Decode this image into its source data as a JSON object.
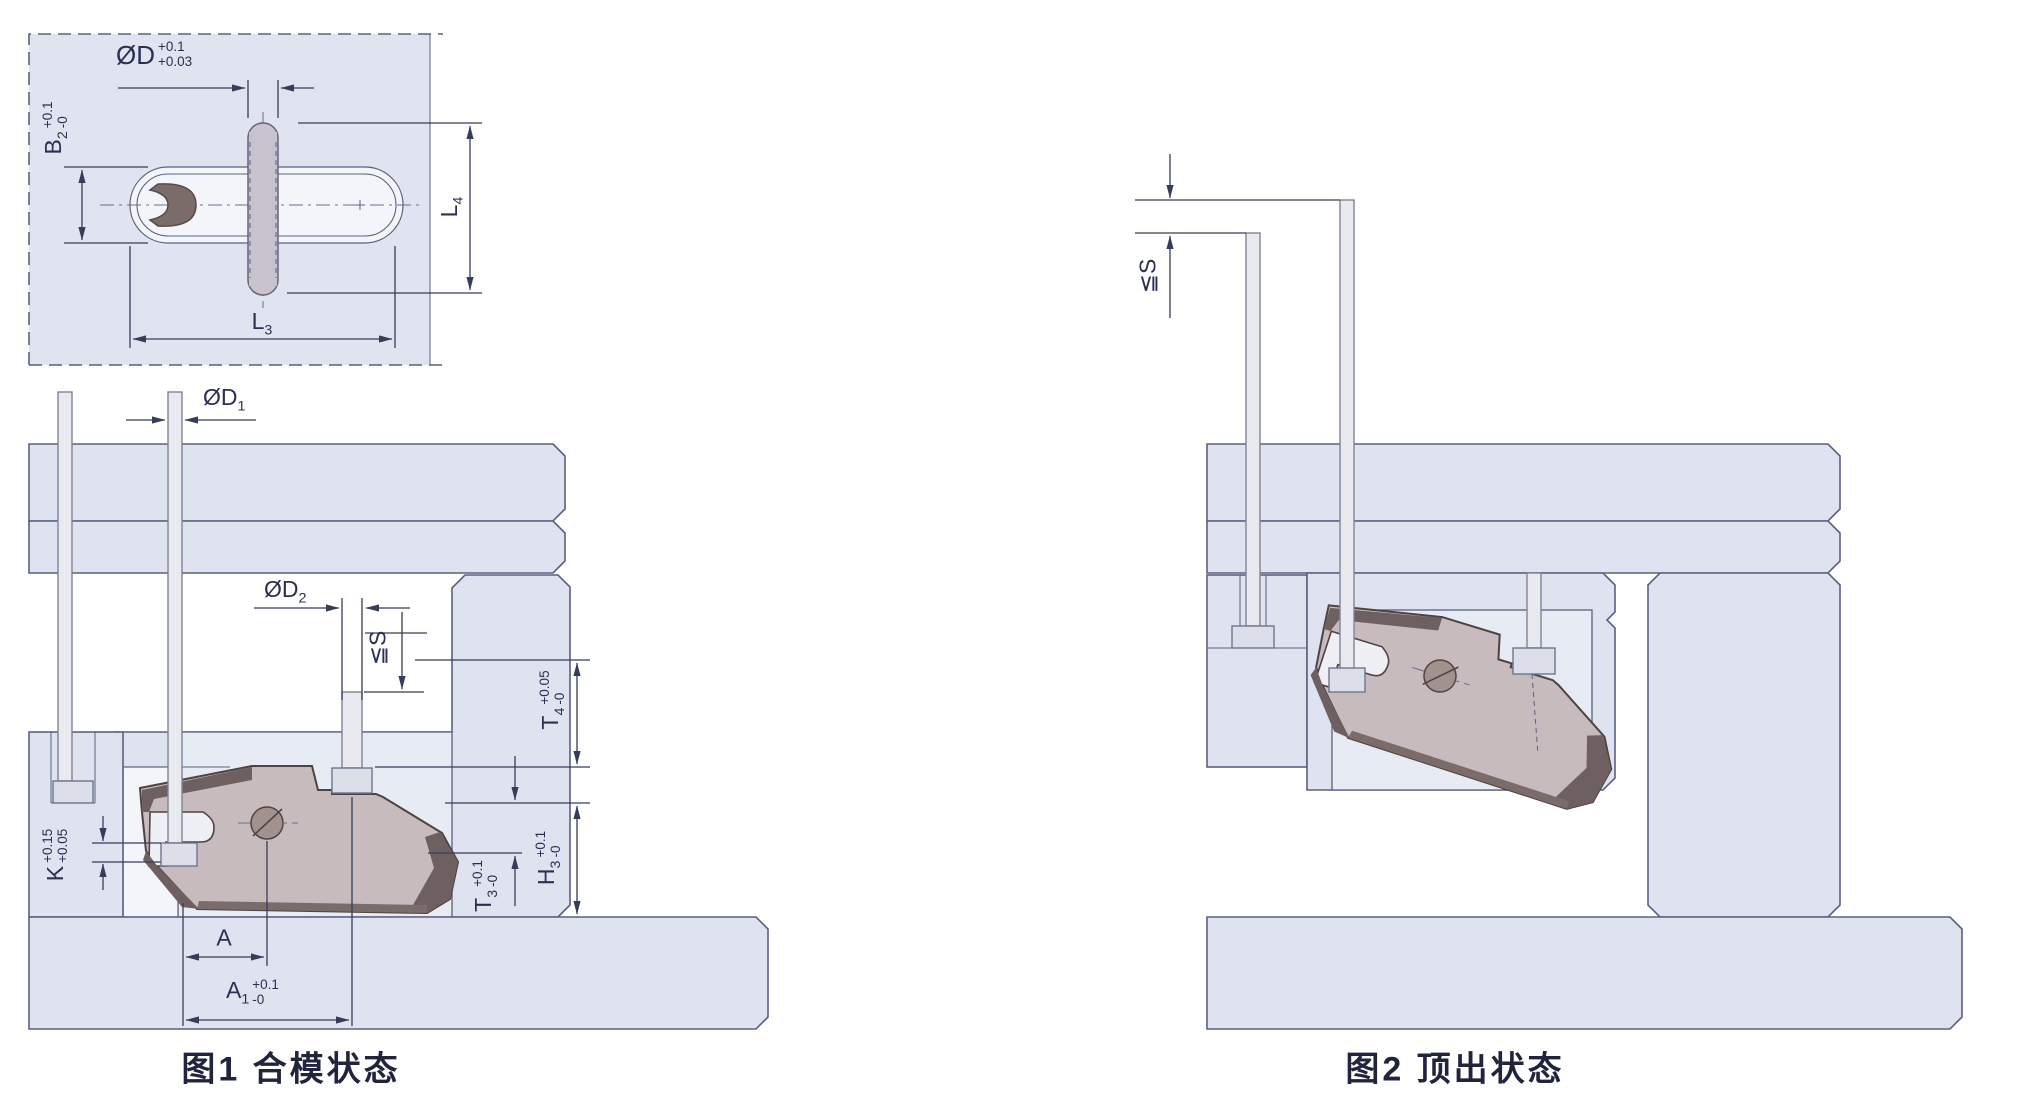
{
  "colors": {
    "background": "#ffffff",
    "plate_fill": "#dee3ef",
    "pocket_fill": "#e7ebf4",
    "outline": "#5b6080",
    "dimension_line": "#373c59",
    "pin_fill": "#e9e9f0",
    "slider_body": "#c7bbbd",
    "slider_dark_face": "#6e6061",
    "label_text": "#2b3052",
    "caption_text": "#20243c"
  },
  "fig1": {
    "caption": "图1 合模状态",
    "detail": {
      "d": {
        "base": "ØD",
        "tol_top": "+0.1",
        "tol_bot": "+0.03"
      },
      "b2": {
        "base": "B",
        "sub": "2",
        "tol_top": "+0.1",
        "tol_bot": "-0"
      },
      "l3": {
        "base": "L",
        "sub": "3"
      },
      "l4": {
        "base": "L",
        "sub": "4"
      }
    },
    "dims": {
      "d1": {
        "base": "ØD",
        "sub": "1"
      },
      "d2": {
        "base": "ØD",
        "sub": "2"
      },
      "s": {
        "base": "≦S"
      },
      "t4": {
        "base": "T",
        "sub": "4",
        "tol_top": "+0.05",
        "tol_bot": "-0"
      },
      "h3": {
        "base": "H",
        "sub": "3",
        "tol_top": "+0.1",
        "tol_bot": "-0"
      },
      "t3": {
        "base": "T",
        "sub": "3",
        "tol_top": "+0.1",
        "tol_bot": "-0"
      },
      "k": {
        "base": "K",
        "tol_top": "+0.15",
        "tol_bot": "+0.05"
      },
      "a": {
        "base": "A"
      },
      "a1": {
        "base": "A",
        "sub": "1",
        "tol_top": "+0.1",
        "tol_bot": "-0"
      }
    }
  },
  "fig2": {
    "caption": "图2 顶出状态",
    "dims": {
      "s": {
        "base": "≦S"
      }
    }
  }
}
